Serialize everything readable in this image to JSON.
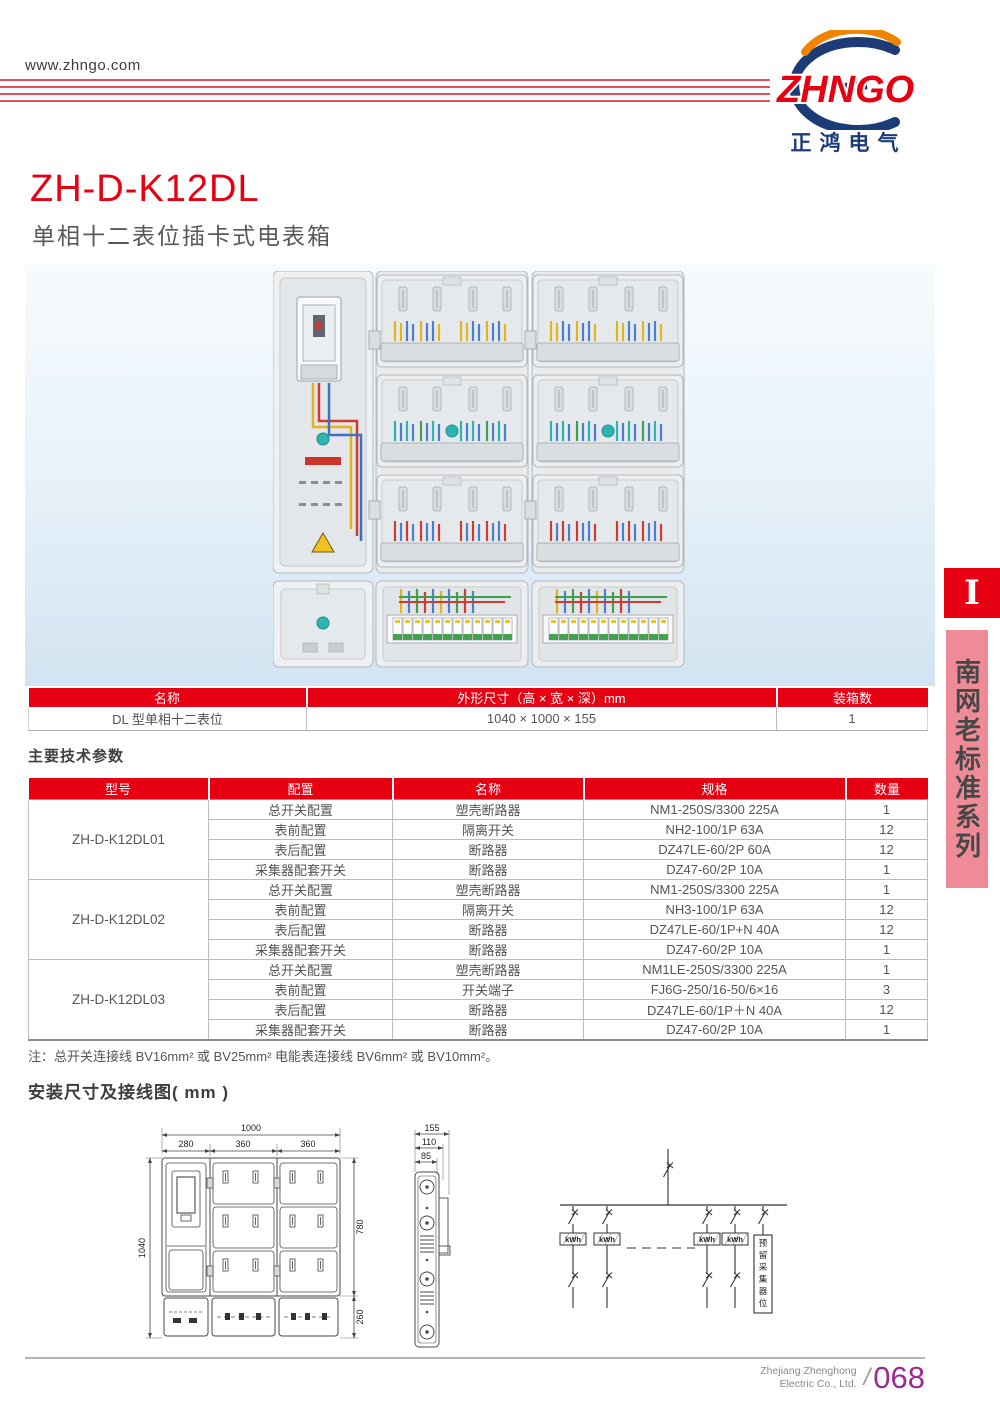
{
  "header": {
    "website": "www.zhngo.com",
    "logo": {
      "brand": "ZHNGO",
      "brand_cn": "正鸿电气"
    }
  },
  "product": {
    "model": "ZH-D-K12DL",
    "subtitle": "单相十二表位插卡式电表箱"
  },
  "spec_table": {
    "headers": [
      "名称",
      "外形尺寸（高 × 宽 × 深）mm",
      "装箱数"
    ],
    "rows": [
      [
        "DL 型单相十二表位",
        "1040 × 1000 × 155",
        "1"
      ]
    ]
  },
  "params_section": {
    "title": "主要技术参数",
    "headers": [
      "型号",
      "配置",
      "名称",
      "规格",
      "数量"
    ],
    "groups": [
      {
        "model": "ZH-D-K12DL01",
        "rows": [
          [
            "总开关配置",
            "塑壳断路器",
            "NM1-250S/3300 225A",
            "1"
          ],
          [
            "表前配置",
            "隔离开关",
            "NH2-100/1P 63A",
            "12"
          ],
          [
            "表后配置",
            "断路器",
            "DZ47LE-60/2P 60A",
            "12"
          ],
          [
            "采集器配套开关",
            "断路器",
            "DZ47-60/2P 10A",
            "1"
          ]
        ]
      },
      {
        "model": "ZH-D-K12DL02",
        "rows": [
          [
            "总开关配置",
            "塑壳断路器",
            "NM1-250S/3300 225A",
            "1"
          ],
          [
            "表前配置",
            "隔离开关",
            "NH3-100/1P 63A",
            "12"
          ],
          [
            "表后配置",
            "断路器",
            "DZ47LE-60/1P+N 40A",
            "12"
          ],
          [
            "采集器配套开关",
            "断路器",
            "DZ47-60/2P 10A",
            "1"
          ]
        ]
      },
      {
        "model": "ZH-D-K12DL03",
        "rows": [
          [
            "总开关配置",
            "塑壳断路器",
            "NM1LE-250S/3300 225A",
            "1"
          ],
          [
            "表前配置",
            "开关端子",
            "FJ6G-250/16-50/6×16",
            "3"
          ],
          [
            "表后配置",
            "断路器",
            "DZ47LE-60/1P＋N 40A",
            "12"
          ],
          [
            "采集器配套开关",
            "断路器",
            "DZ47-60/2P 10A",
            "1"
          ]
        ]
      }
    ],
    "note": "注：总开关连接线 BV16mm² 或 BV25mm² 电能表连接线 BV6mm² 或 BV10mm²。"
  },
  "install_section": {
    "title": "安装尺寸及接线图( mm )",
    "front_view": {
      "w_total": "1000",
      "w1": "280",
      "w2": "360",
      "w3": "360",
      "h_total": "1040",
      "h_upper": "780",
      "h_lower": "260"
    },
    "side_view": {
      "d1": "155",
      "d2": "110",
      "d3": "85"
    },
    "wiring": {
      "kwh": "kWh",
      "collector_chars": [
        "预",
        "留",
        "采",
        "集",
        "器",
        "位"
      ]
    }
  },
  "side_tab": {
    "index": "I",
    "series": "南网老标准系列"
  },
  "footer": {
    "company_line1": "Zhejiang Zhenghong",
    "company_line2": "Electric Co., Ltd.",
    "sep": "/",
    "page": "068"
  },
  "colors": {
    "accent_red": "#e60012",
    "logo_blue": "#1d3c77",
    "logo_orange": "#f08300",
    "tab_pink": "#ee8b97",
    "page_purple": "#9c2b91"
  }
}
